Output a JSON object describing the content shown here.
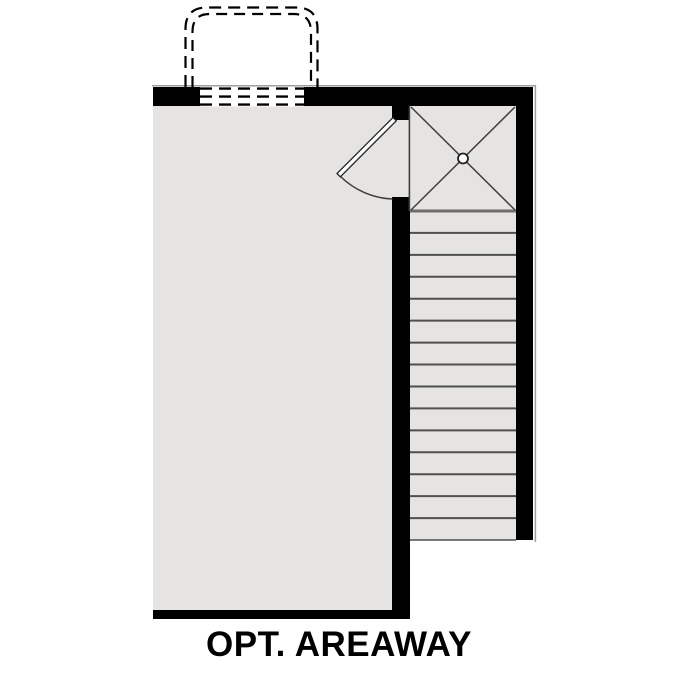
{
  "title": {
    "label": "OPT. AREAWAY"
  },
  "colors": {
    "wall": "#000000",
    "floor": "#e5e4e2",
    "stair_line": "#4f4f4f",
    "detail_line": "#3f3f3f",
    "landing_edge": "#6e6e6e",
    "shadow": "#9e9e9e",
    "door_leaf_fill": "#ffffff",
    "door_outline": "#222222",
    "background": "#ffffff"
  },
  "plan": {
    "room": {
      "kind": "open-floor-area"
    },
    "stairs": {
      "treads": 15,
      "run": "vertical"
    },
    "landing": {
      "marker": "x-cross",
      "drain_marker": "circle"
    },
    "door": {
      "type": "single-swing",
      "state": "open"
    },
    "areaway": {
      "outline_style": "dashed-double-line",
      "window_dashed_lines": 3
    }
  }
}
